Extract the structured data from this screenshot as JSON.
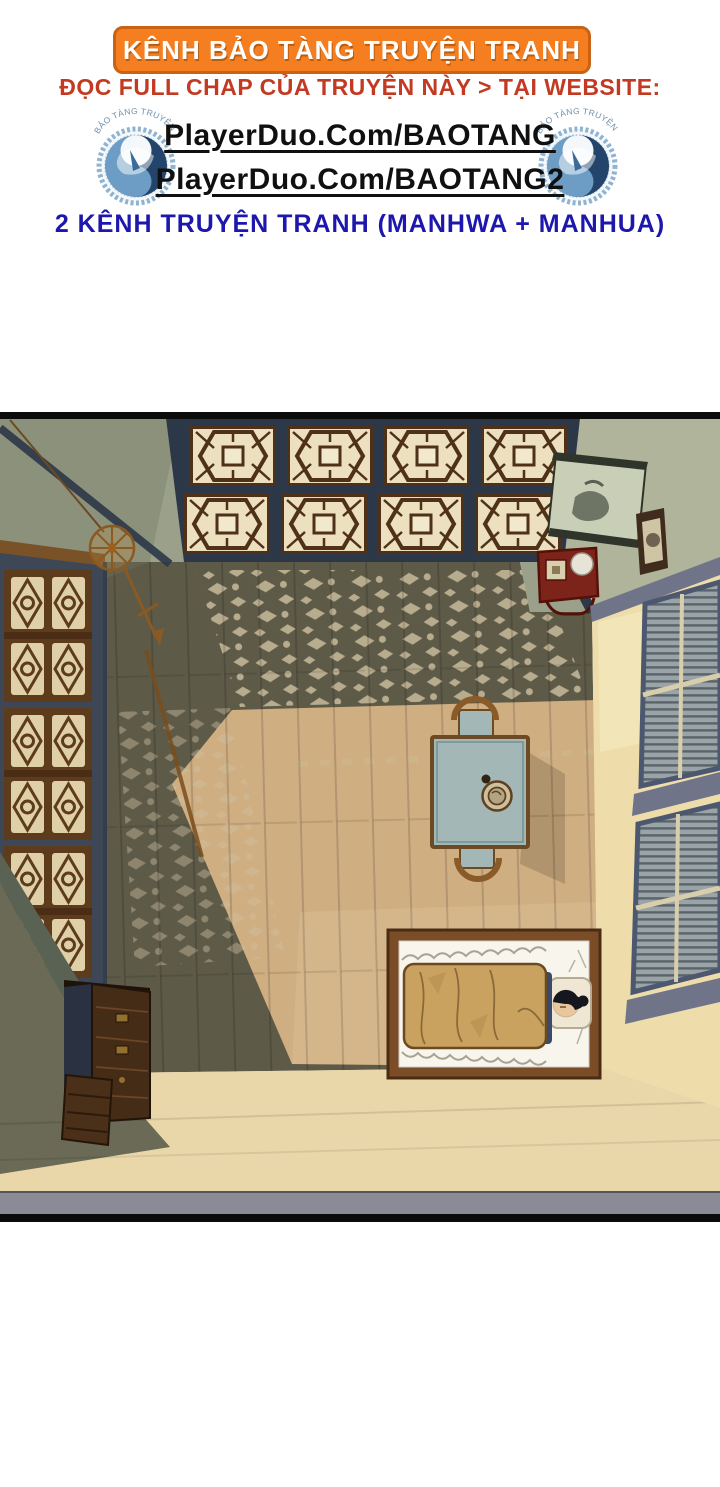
{
  "header": {
    "banner_label": "KÊNH BẢO TÀNG TRUYỆN TRANH",
    "subtitle": "ĐỌC FULL CHAP CỦA TRUYỆN NÀY > TẠI WEBSITE:",
    "links": [
      {
        "label": "PlayerDuo.Com/BAOTANG"
      },
      {
        "label": "PlayerDuo.Com/BAOTANG2"
      }
    ],
    "footer_note": "2 KÊNH TRUYỆN TRANH (MANHWA + MANHUA)",
    "logo_arc_text": "BẢO TÀNG TRUYỆN TRANH",
    "colors": {
      "banner_bg": "#f57f20",
      "banner_border": "#c96212",
      "subtitle_red": "#c23a22",
      "link_black": "#101010",
      "footer_blue": "#1d17ad",
      "logo_blue": "#24456b"
    }
  },
  "panel": {
    "colors": {
      "floor_lit": "#cfae82",
      "floor_shadow": "#5e5a48",
      "ceiling_green": "#9aa089",
      "beam_slate": "#2c3847",
      "left_wall_slate": "#3e4756",
      "lattice_wood": "#5d3b1d",
      "wall_cream": "#eedcab",
      "trim_gray": "#6f7488",
      "table_top": "#a2b7b6",
      "bed_wood": "#7b4d26",
      "blanket_tan": "#c9a260",
      "shrine_red": "#7d241a",
      "scroll_green": "#c9cfb6",
      "verandah_cream": "#ead7a9",
      "bottom_band": "#8b8b98"
    }
  }
}
